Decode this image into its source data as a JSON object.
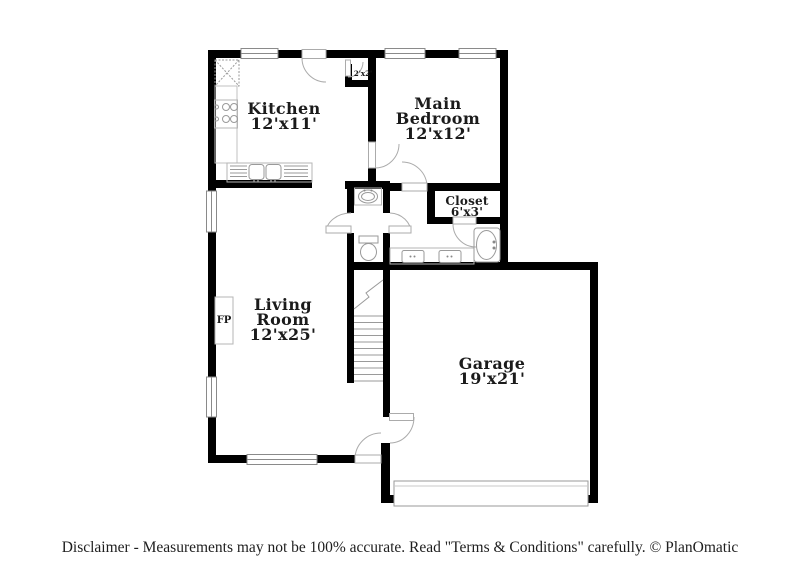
{
  "page": {
    "background": "#ffffff",
    "wall_color": "#000000",
    "fixture_line_color": "#a6a6a6"
  },
  "floorplan": {
    "rooms": [
      {
        "id": "kitchen",
        "name": "Kitchen",
        "dims": "12'x11'"
      },
      {
        "id": "main-bedroom",
        "name": "Main Bedroom",
        "dims": "12'x12'"
      },
      {
        "id": "closet",
        "name": "Closet",
        "dims": "6'x3'"
      },
      {
        "id": "living-room",
        "name": "Living Room",
        "dims": "12'x25'"
      },
      {
        "id": "garage",
        "name": "Garage",
        "dims": "19'x21'"
      }
    ],
    "annotations": {
      "fireplace": "FP",
      "entry_closet_dims": "2'x2'"
    }
  },
  "footer": {
    "disclaimer": "Disclaimer - Measurements may not be 100% accurate. Read \"Terms & Conditions\" carefully. © PlanOmatic"
  }
}
